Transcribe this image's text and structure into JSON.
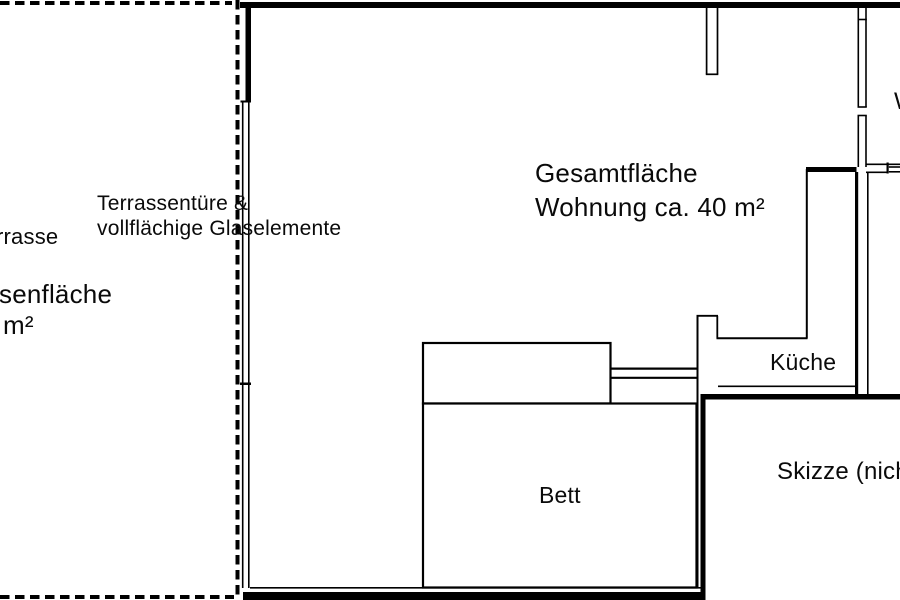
{
  "colors": {
    "line": "#000000",
    "background": "#ffffff",
    "text": "#0a0a0a"
  },
  "labels": {
    "total_area_line1": "Gesamtfläche",
    "total_area_line2": "Wohnung ca. 40 m²",
    "terrace_door_line1": "Terrassentüre &",
    "terrace_door_line2": "vollflächige Glaselemente",
    "terrace_partial": "rrasse",
    "terrace_area_partial_line1": "senfläche",
    "terrace_area_partial_line2": "m²",
    "kitchen": "Küche",
    "bed": "Bett",
    "sketch_note_partial": "Skizze (nich",
    "right_room_partial": "W"
  }
}
